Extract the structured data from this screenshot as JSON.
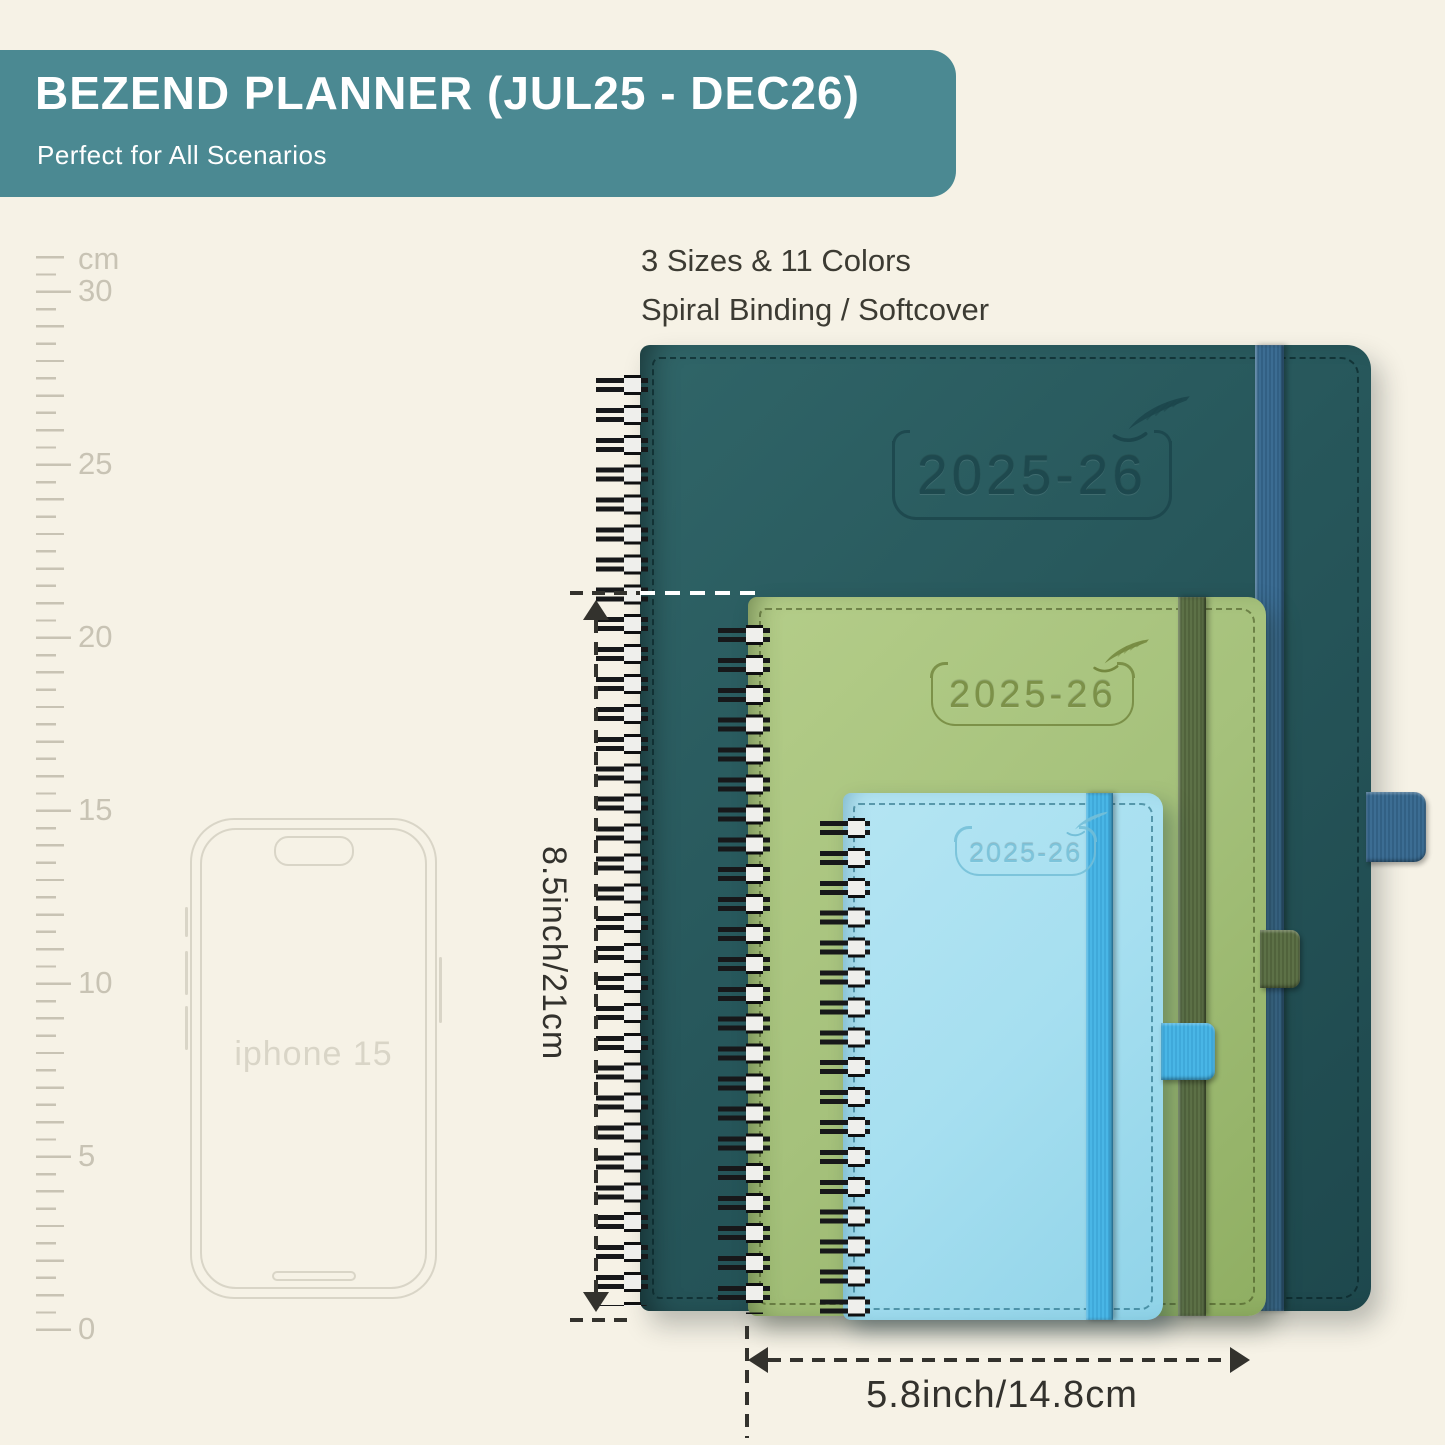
{
  "banner": {
    "title": "BEZEND PLANNER (JUL25 - DEC26)",
    "subtitle": "Perfect for All Scenarios"
  },
  "features": {
    "line1": "3 Sizes & 11 Colors",
    "line2": "Spiral Binding / Softcover"
  },
  "ruler": {
    "unit": "cm",
    "labels": [
      "30",
      "25",
      "20",
      "15",
      "10",
      "5",
      "0"
    ]
  },
  "phone": {
    "label": "iphone 15"
  },
  "planners": {
    "large": {
      "year": "2025-26",
      "cover_color": "#27575b",
      "band_color": "#3c6d93"
    },
    "medium": {
      "year": "2025-26",
      "cover_color": "#a5c17b",
      "band_color": "#5d7147"
    },
    "small": {
      "year": "2025-26",
      "cover_color": "#a6dff0",
      "band_color": "#49b6e6"
    }
  },
  "dimensions": {
    "height_label": "8.5inch/21cm",
    "width_label": "5.8inch/14.8cm"
  },
  "colors": {
    "background": "#f6f2e6",
    "banner": "#4b8992",
    "title-text": "#ffffff",
    "body-text": "#3c3b33",
    "ruler": "#c8c3b4",
    "phone-outline": "#d9d5c7",
    "teal-cover": "#27575b",
    "teal-deboss": "#1c464c",
    "teal-band": "#3c6d93",
    "green-cover": "#a5c17b",
    "green-deboss": "#74883f",
    "green-band": "#5d7147",
    "blue-cover": "#a6dff0",
    "blue-deboss": "#74bfd8",
    "blue-band": "#49b6e6",
    "wire": "#17181a",
    "dimension-ink": "#33322d"
  }
}
